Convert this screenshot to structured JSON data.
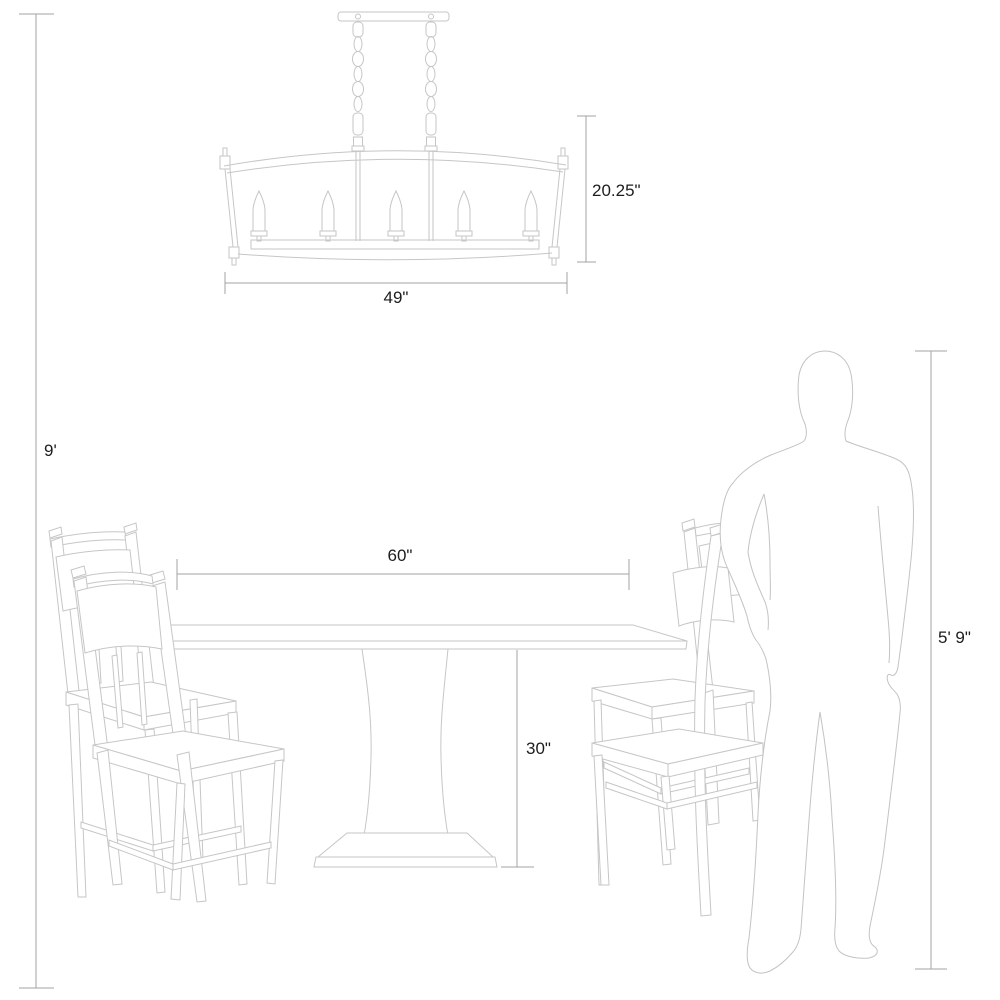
{
  "diagram": {
    "title": "Dining set with linear chandelier — scale and dimension diagram",
    "labels": {
      "ceiling_height": "9'",
      "chandelier_height": "20.25\"",
      "chandelier_width": "49\"",
      "table_width": "60\"",
      "table_height": "30\"",
      "person_height": "5' 9\""
    },
    "objects": {
      "chandelier": "linear candle chandelier",
      "chandelier_light_count": 5,
      "table": "pedestal dining table",
      "chair_count": 4,
      "person": "standing human figure for scale"
    },
    "colors": {
      "background": "#ffffff",
      "furniture_line": "#c6c6c6",
      "figure_line": "#c3c3c3",
      "dimension_line": "#a3a3a3",
      "label_text": "#1d1d1d"
    }
  }
}
